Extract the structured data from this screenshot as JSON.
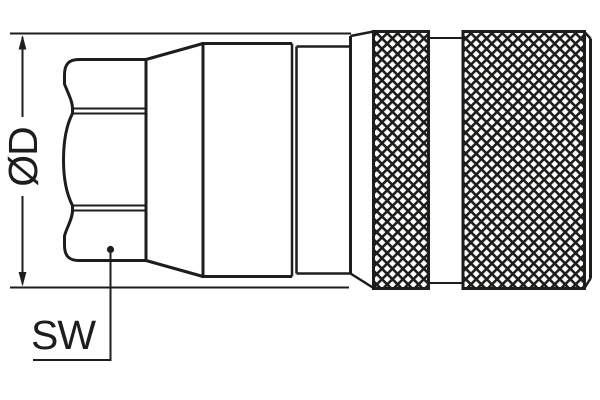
{
  "drawing": {
    "labels": {
      "diameter": "ØD",
      "wrench_size": "SW"
    },
    "colors": {
      "line": "#1d1d1b",
      "background": "#ffffff"
    }
  }
}
